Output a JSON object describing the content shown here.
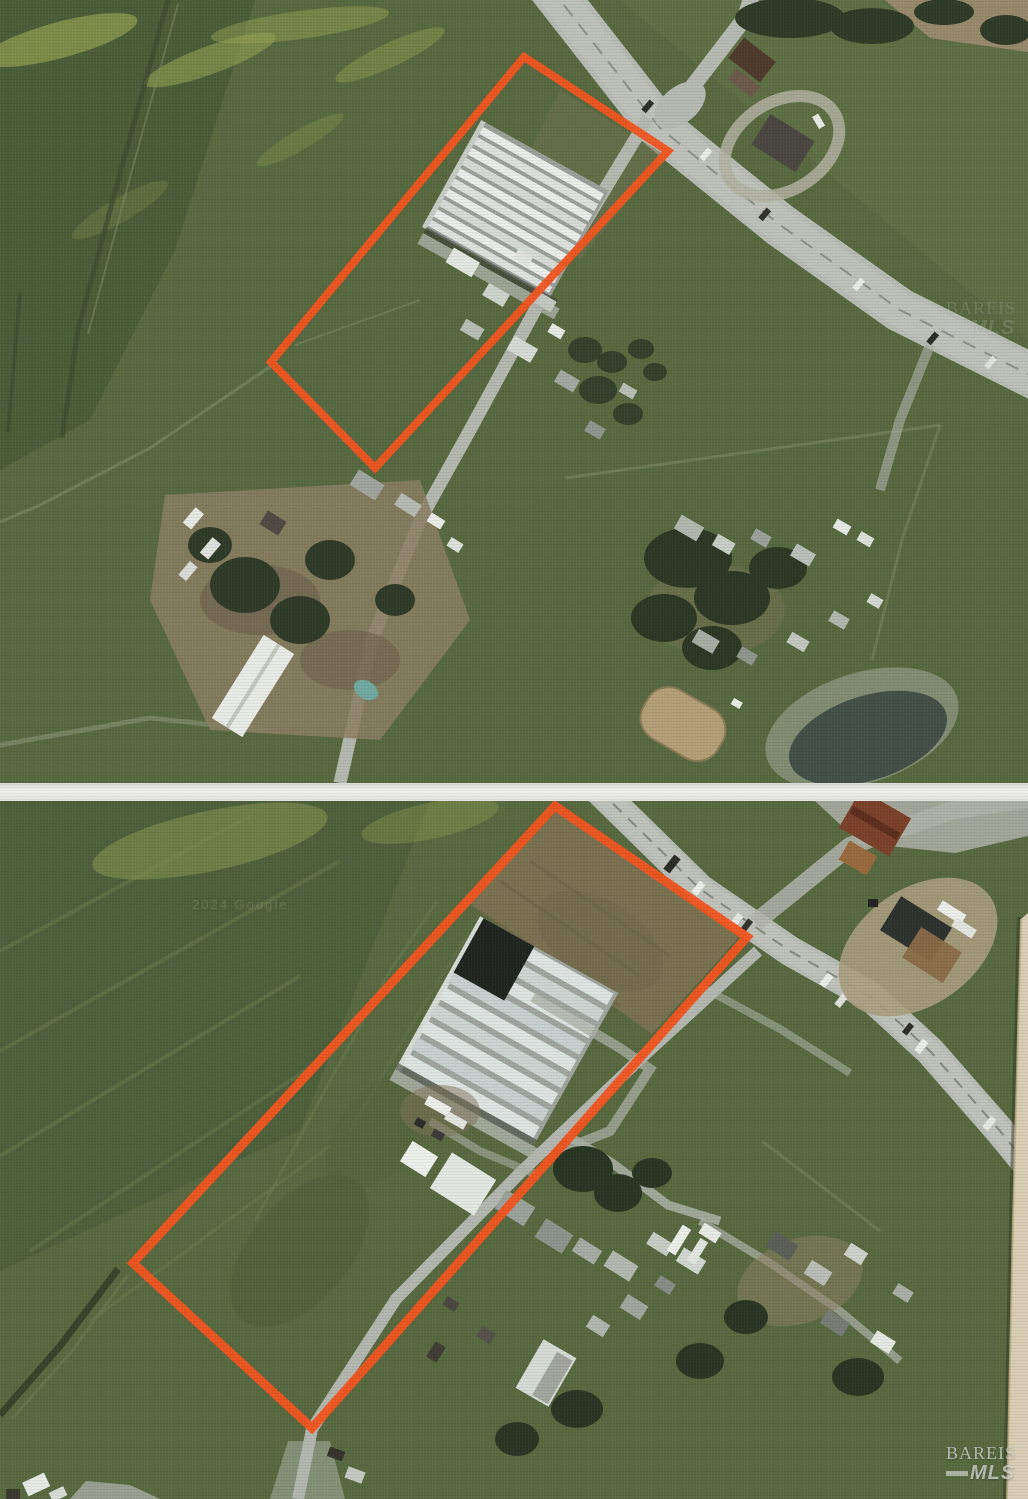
{
  "page": {
    "description": "Two stacked aerial photographs of a rural parcel outlined in orange, with greenhouses inside the boundary"
  },
  "photos": [
    {
      "id": "top",
      "label": "aerial-overview",
      "watermark": {
        "brand": "BAREIS",
        "sub": "MLS"
      }
    },
    {
      "id": "bottom",
      "label": "aerial-closeup",
      "watermark": {
        "brand": "BAREIS",
        "sub": "MLS"
      },
      "attribution": "2024 Google"
    }
  ],
  "colors": {
    "boundary_orange": "#F2531D",
    "watermark_gray": "#CDD0CD",
    "divider_white": "#F0F0EC",
    "page_edge_beige": "#D8CDB4",
    "grass_green": "#57683F"
  }
}
